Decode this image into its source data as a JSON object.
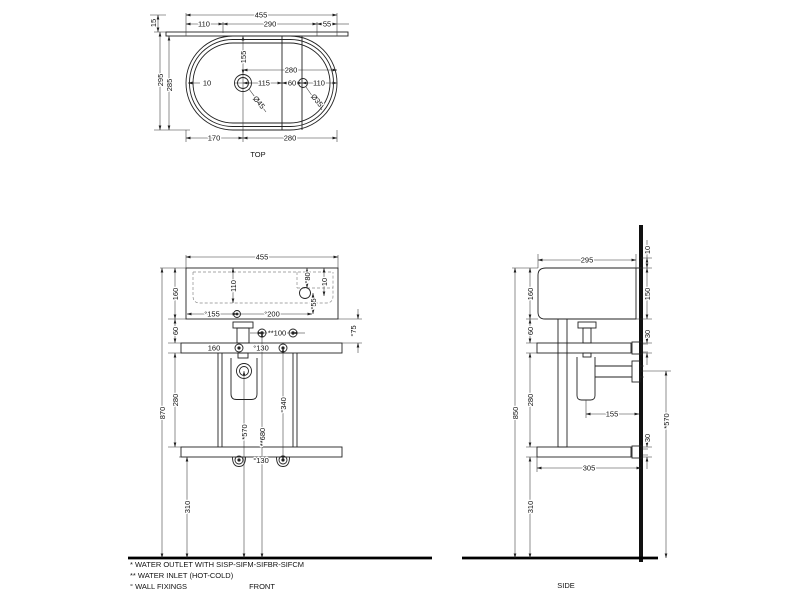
{
  "drawing": {
    "accent_color": "#222222",
    "views": {
      "top": {
        "title": "TOP",
        "labels": [
          {
            "t": "455",
            "x": 261,
            "y": 17.5
          },
          {
            "t": "110",
            "x": 204,
            "y": 26.5
          },
          {
            "t": "290",
            "x": 270,
            "y": 26.5
          },
          {
            "t": "55",
            "x": 327,
            "y": 26.5
          },
          {
            "t": "15",
            "x": 156,
            "y": 23,
            "r": -90
          },
          {
            "t": "295",
            "x": 163,
            "y": 80,
            "r": -90
          },
          {
            "t": "285",
            "x": 172,
            "y": 85,
            "r": -90
          },
          {
            "t": "155",
            "x": 246,
            "y": 57,
            "r": -90
          },
          {
            "t": "10",
            "x": 207,
            "y": 85.5
          },
          {
            "t": "115",
            "x": 264,
            "y": 85.5
          },
          {
            "t": "60",
            "x": 292,
            "y": 85.5
          },
          {
            "t": "110",
            "x": 319,
            "y": 85.5
          },
          {
            "t": "280",
            "x": 291,
            "y": 72.5
          },
          {
            "t": "170",
            "x": 214,
            "y": 140.5
          },
          {
            "t": "280",
            "x": 290,
            "y": 140.5
          },
          {
            "t": "Ø45",
            "x": 257,
            "y": 104,
            "r": 50,
            "n": "diameter-label"
          },
          {
            "t": "Ø35",
            "x": 315,
            "y": 102,
            "r": 50,
            "n": "diameter-label"
          },
          {
            "t": "TOP",
            "x": 258,
            "y": 157,
            "s": 6.5,
            "n": "view-title"
          }
        ]
      },
      "front": {
        "title": "FRONT",
        "labels": [
          {
            "t": "455",
            "x": 262,
            "y": 259.5
          },
          {
            "t": "870",
            "x": 165,
            "y": 413,
            "r": -90
          },
          {
            "t": "160",
            "x": 178,
            "y": 294,
            "r": -90
          },
          {
            "t": "60",
            "x": 178,
            "y": 331,
            "r": -90
          },
          {
            "t": "280",
            "x": 178,
            "y": 400,
            "r": -90
          },
          {
            "t": "310",
            "x": 190,
            "y": 507,
            "r": -90
          },
          {
            "t": "110",
            "x": 236,
            "y": 286,
            "r": -90
          },
          {
            "t": "°80",
            "x": 310,
            "y": 278,
            "r": -90
          },
          {
            "t": "10",
            "x": 327,
            "y": 282,
            "r": -90
          },
          {
            "t": "°55",
            "x": 316,
            "y": 304,
            "r": -90
          },
          {
            "t": "°155",
            "x": 212,
            "y": 316.5
          },
          {
            "t": "°200",
            "x": 272,
            "y": 316.5
          },
          {
            "t": "**100",
            "x": 277,
            "y": 335.5
          },
          {
            "t": "160",
            "x": 214,
            "y": 350.5
          },
          {
            "t": "°130",
            "x": 261,
            "y": 350.5
          },
          {
            "t": "°75",
            "x": 356,
            "y": 331,
            "r": -90
          },
          {
            "t": "*570",
            "x": 247,
            "y": 432,
            "r": -90
          },
          {
            "t": "**680",
            "x": 265,
            "y": 437,
            "r": -90
          },
          {
            "t": "°340",
            "x": 286,
            "y": 405,
            "r": -90
          },
          {
            "t": "°130",
            "x": 261,
            "y": 463
          },
          {
            "t": "FRONT",
            "x": 262,
            "y": 589,
            "s": 6.5,
            "n": "view-title"
          }
        ]
      },
      "side": {
        "title": "SIDE",
        "labels": [
          {
            "t": "295",
            "x": 587,
            "y": 262.5
          },
          {
            "t": "850",
            "x": 518,
            "y": 413,
            "r": -90
          },
          {
            "t": "160",
            "x": 533,
            "y": 294,
            "r": -90
          },
          {
            "t": "60",
            "x": 533,
            "y": 331,
            "r": -90
          },
          {
            "t": "280",
            "x": 533,
            "y": 400,
            "r": -90
          },
          {
            "t": "310",
            "x": 533,
            "y": 507,
            "r": -90
          },
          {
            "t": "10",
            "x": 650,
            "y": 250,
            "r": -90
          },
          {
            "t": "150",
            "x": 650,
            "y": 294,
            "r": -90
          },
          {
            "t": "30",
            "x": 650,
            "y": 334,
            "r": -90
          },
          {
            "t": "30",
            "x": 650,
            "y": 438,
            "r": -90
          },
          {
            "t": "*570",
            "x": 669,
            "y": 421,
            "r": -90
          },
          {
            "t": "155",
            "x": 612,
            "y": 416.5
          },
          {
            "t": "305",
            "x": 589,
            "y": 470.5
          },
          {
            "t": "SIDE",
            "x": 566,
            "y": 588,
            "s": 6.5,
            "n": "view-title"
          }
        ]
      }
    },
    "legend": {
      "labels": [
        {
          "t": "*  WATER OUTLET WITH SISP-SIFM-SIFBR-SIFCM",
          "x": 130,
          "y": 567,
          "a": "start",
          "s": 6,
          "n": "note-water-outlet"
        },
        {
          "t": "** WATER INLET  (HOT-COLD)",
          "x": 130,
          "y": 578,
          "a": "start",
          "s": 6,
          "n": "note-water-inlet"
        },
        {
          "t": "°  WALL FIXINGS",
          "x": 130,
          "y": 589,
          "a": "start",
          "s": 6,
          "n": "note-wall-fixings"
        }
      ]
    }
  }
}
